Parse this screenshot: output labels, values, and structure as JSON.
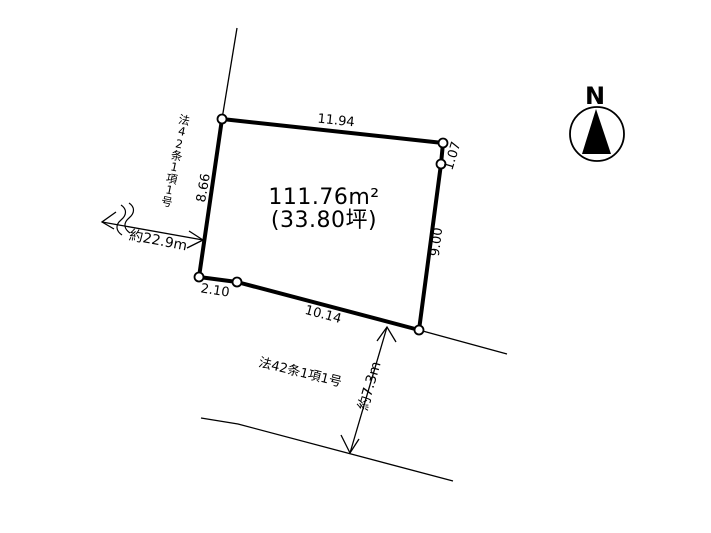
{
  "compass": {
    "north_label": "N"
  },
  "parcel": {
    "area_m2": "111.76m²",
    "area_tsubo": "(33.80坪)",
    "edge_lengths": {
      "top": "11.94",
      "upper_right": "1.07",
      "right": "9.00",
      "bottom": "10.14",
      "lower_left": "2.10",
      "left": "8.66"
    }
  },
  "roads": {
    "west_road_label": "法42条1項1号",
    "south_road_label": "法42条1項1号",
    "west_road_distance": "約22.9m",
    "south_road_width": "約7.3m"
  },
  "colors": {
    "line": "#000000",
    "background": "#ffffff"
  }
}
